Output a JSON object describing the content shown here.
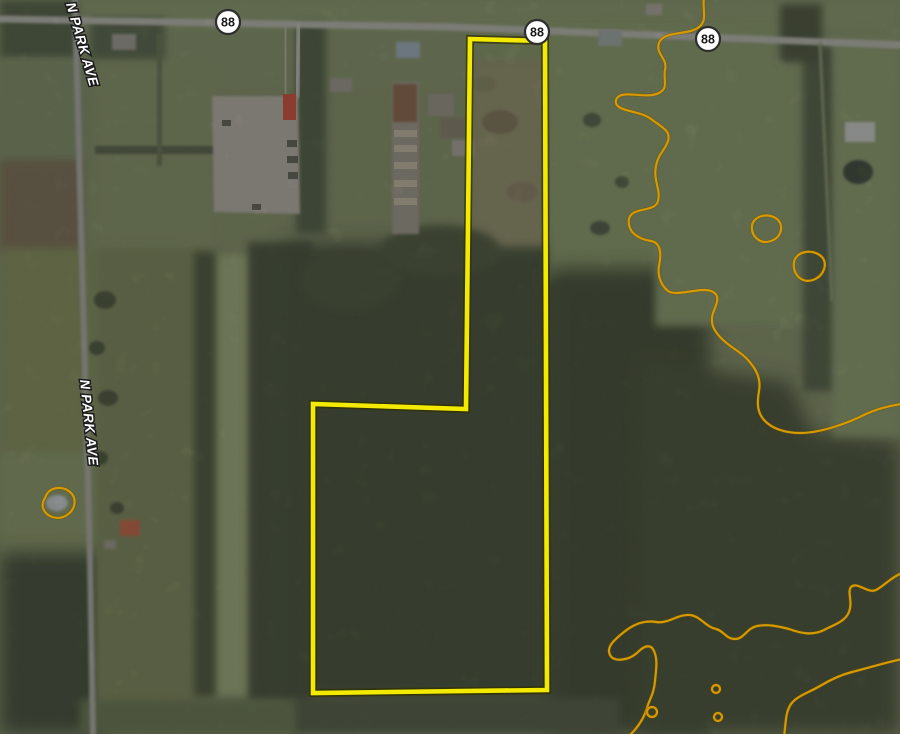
{
  "map": {
    "width": 900,
    "height": 734,
    "background": "#75815a",
    "palette": {
      "boundary_yellow": "#f3ea00",
      "boundary_edge": "#2f2f00",
      "contour_orange": "#d69a00",
      "contour_edge": "#6b4e00",
      "road_gray": "#a8a8a0",
      "shield_fill": "#ffffff",
      "shield_border": "#2d2d2d",
      "label_white": "#ffffff"
    },
    "street_labels": [
      {
        "text": "N PARK AVE",
        "x": 66,
        "y": 4,
        "rot": 74,
        "size": 13.5
      },
      {
        "text": "N PARK AVE",
        "x": 80,
        "y": 380,
        "rot": 84,
        "size": 13.5
      }
    ],
    "route_shields": [
      {
        "label": "88",
        "x": 228,
        "y": 22,
        "r": 12
      },
      {
        "label": "88",
        "x": 537,
        "y": 32,
        "r": 12
      },
      {
        "label": "88",
        "x": 708,
        "y": 39,
        "r": 12
      }
    ],
    "boundary": {
      "name": "property-boundary",
      "points": "470,39 545,41 547,690 313,693 313,404 466,409",
      "width": 4.6,
      "edge_width": 8
    },
    "contours": {
      "width": 2.2,
      "edge_width": 3.6,
      "paths": [
        {
          "name": "contour-line-upper",
          "d": "M 704,-3 C 702,10 708,20 699,27 C 688,36 664,30 659,43 C 655,54 668,58 665,70 C 663,80 669,88 659,93 C 645,100 620,88 616,100 C 613,112 640,110 651,119 C 663,128 671,131 668,141 C 664,152 658,154 656,166 C 653,180 661,190 658,201 C 655,213 632,206 629,219 C 627,231 637,239 651,241 C 662,243 661,256 659,266 C 657,278 663,287 668,291 C 676,297 700,287 711,291 C 722,295 716,305 713,313 C 710,323 713,330 722,339 C 731,348 740,351 748,360 C 757,370 761,379 759,391 C 757,403 757,412 764,420 C 772,429 786,433 800,433 C 820,433 846,424 866,414 C 877,409 888,406 902,404"
        },
        {
          "name": "contour-line-lower",
          "d": "M 902,573 C 890,578 884,586 876,590 C 868,594 857,581 851,587 C 847,592 853,602 849,612 C 845,622 833,625 824,630 C 812,636 800,633 789,629 C 777,626 768,624 757,626 C 747,628 744,639 735,639 C 726,639 724,631 716,629 C 706,627 700,616 690,615 C 678,614 668,624 656,622 C 644,620 634,624 624,632 C 614,640 606,647 610,655 C 614,663 630,660 638,652 C 645,645 651,644 654,651 C 658,660 656,670 655,681 C 654,694 649,700 647,708 C 644,718 639,726 631,734"
        },
        {
          "name": "contour-line-corner",
          "d": "M 902,659 C 884,663 868,668 852,672 C 840,675 830,680 820,686 C 808,693 797,696 791,704 C 785,713 786,724 784,736"
        },
        {
          "name": "contour-ring",
          "d": "M 752,226 C 753,216 768,212 777,219 C 784,225 782,237 771,241 C 760,245 751,236 752,226 Z"
        },
        {
          "name": "contour-ring",
          "d": "M 794,262 C 796,251 813,248 822,257 C 828,264 824,276 813,280 C 801,284 792,273 794,262 Z"
        },
        {
          "name": "contour-ring-pond",
          "d": "M 45,498 C 48,487 62,485 70,492 C 77,498 76,509 67,515 C 58,521 46,517 43,508 C 42,504 43,501 45,498 Z"
        }
      ],
      "rings": [
        {
          "name": "contour-ring-small",
          "cx": 652,
          "cy": 712,
          "r": 5
        },
        {
          "name": "contour-ring-small",
          "cx": 716,
          "cy": 689,
          "r": 4
        },
        {
          "name": "contour-ring-small",
          "cx": 718,
          "cy": 717,
          "r": 4
        }
      ]
    },
    "roads": [
      {
        "name": "route-88-road",
        "pts": "0,19 450,27 900,45",
        "w": 7,
        "stroke": "#a8a8a0"
      },
      {
        "name": "n-park-ave-road",
        "pts": "75,0 83,300 90,560 93,734",
        "w": 6,
        "stroke": "#9c9c95"
      },
      {
        "name": "side-road",
        "pts": "299,26 297,96",
        "w": 5,
        "stroke": "#b2b2aa"
      },
      {
        "name": "driveway",
        "pts": "285,28 286,96",
        "w": 3,
        "stroke": "#aeaaa0"
      },
      {
        "name": "farm-lane",
        "pts": "820,44 832,300",
        "w": 3,
        "stroke": "#7d8a62"
      }
    ],
    "patches": [
      {
        "t": "rect",
        "x": 0,
        "y": 0,
        "w": 900,
        "h": 34,
        "fill": "#7b8a5f",
        "f": 2,
        "name": "field"
      },
      {
        "t": "rect",
        "x": 0,
        "y": 30,
        "w": 900,
        "h": 60,
        "fill": "#78855c",
        "f": 2,
        "name": "field"
      },
      {
        "t": "rect",
        "x": 0,
        "y": 0,
        "w": 78,
        "h": 58,
        "fill": "#46523a",
        "f": 2,
        "name": "trees"
      },
      {
        "t": "rect",
        "x": 90,
        "y": 18,
        "w": 75,
        "h": 45,
        "fill": "#4e5a40",
        "f": 2,
        "name": "trees"
      },
      {
        "t": "rect",
        "x": 0,
        "y": 60,
        "w": 95,
        "h": 110,
        "fill": "#72805a",
        "f": 2,
        "name": "field"
      },
      {
        "t": "rect",
        "x": 0,
        "y": 160,
        "w": 82,
        "h": 95,
        "fill": "#6e6249",
        "f": 2,
        "name": "plowed-field"
      },
      {
        "t": "rect",
        "x": 0,
        "y": 248,
        "w": 95,
        "h": 215,
        "fill": "#76804f",
        "f": 2,
        "name": "field"
      },
      {
        "t": "rect",
        "x": 0,
        "y": 452,
        "w": 100,
        "h": 115,
        "fill": "#7d8a5c",
        "f": 2,
        "name": "lawn"
      },
      {
        "t": "rect",
        "x": 0,
        "y": 552,
        "w": 108,
        "h": 182,
        "fill": "#39432e",
        "f": 3,
        "name": "trees"
      },
      {
        "t": "rect",
        "x": 95,
        "y": 60,
        "w": 120,
        "h": 190,
        "fill": "#77845a",
        "f": 2,
        "name": "field"
      },
      {
        "t": "rect",
        "x": 95,
        "y": 248,
        "w": 115,
        "h": 465,
        "fill": "#6f7a50",
        "f": 2,
        "name": "field"
      },
      {
        "t": "rect",
        "x": 211,
        "y": 255,
        "w": 42,
        "h": 440,
        "fill": "#8e9b6c",
        "f": 2,
        "name": "grass-strip"
      },
      {
        "t": "rect",
        "x": 194,
        "y": 252,
        "w": 22,
        "h": 445,
        "fill": "#414c33",
        "f": 2,
        "name": "tree-row"
      },
      {
        "t": "rect",
        "x": 248,
        "y": 242,
        "w": 64,
        "h": 460,
        "fill": "#3c4731",
        "f": 2,
        "name": "tree-row"
      },
      {
        "t": "rect",
        "x": 283,
        "y": 243,
        "w": 282,
        "h": 460,
        "fill": "#3b452d",
        "f": 3,
        "name": "forest"
      },
      {
        "t": "rect",
        "x": 296,
        "y": 24,
        "w": 30,
        "h": 210,
        "fill": "#45513a",
        "f": 2,
        "name": "tree-row"
      },
      {
        "t": "rect",
        "x": 468,
        "y": 34,
        "w": 80,
        "h": 42,
        "fill": "#77875a",
        "f": 2,
        "name": "field"
      },
      {
        "t": "rect",
        "x": 470,
        "y": 60,
        "w": 76,
        "h": 185,
        "fill": "#84815e",
        "f": 2,
        "name": "scrub-field"
      },
      {
        "t": "rect",
        "x": 548,
        "y": 26,
        "w": 185,
        "h": 255,
        "fill": "#7c8c5d",
        "f": 2,
        "name": "field"
      },
      {
        "t": "rect",
        "x": 548,
        "y": 268,
        "w": 162,
        "h": 466,
        "fill": "#38422c",
        "f": 3,
        "name": "forest"
      },
      {
        "t": "polygon",
        "pts": "640,360 790,382 812,432 900,442 900,734 640,734",
        "fill": "#3c462e",
        "f": 3,
        "name": "forest"
      },
      {
        "t": "rect",
        "x": 655,
        "y": 26,
        "w": 150,
        "h": 300,
        "fill": "#7b8b5e",
        "f": 2,
        "name": "field"
      },
      {
        "t": "rect",
        "x": 803,
        "y": 46,
        "w": 32,
        "h": 345,
        "fill": "#46523a",
        "f": 2,
        "name": "tree-row"
      },
      {
        "t": "rect",
        "x": 833,
        "y": 36,
        "w": 67,
        "h": 400,
        "fill": "#7e8d60",
        "f": 2,
        "name": "field"
      },
      {
        "t": "rect",
        "x": 780,
        "y": 4,
        "w": 42,
        "h": 58,
        "fill": "#3f4a33",
        "f": 2,
        "name": "trees"
      },
      {
        "t": "rect",
        "x": 95,
        "y": 146,
        "w": 120,
        "h": 8,
        "fill": "#4b573d",
        "f": 1,
        "name": "hedgerow"
      },
      {
        "t": "rect",
        "x": 157,
        "y": 34,
        "w": 5,
        "h": 132,
        "fill": "#5a6647",
        "f": 1,
        "name": "hedgerow"
      },
      {
        "t": "rect",
        "x": 290,
        "y": 698,
        "w": 330,
        "h": 36,
        "fill": "#46513a",
        "f": 2,
        "name": "trees"
      },
      {
        "t": "rect",
        "x": 80,
        "y": 700,
        "w": 215,
        "h": 34,
        "fill": "#5c6a45",
        "f": 2,
        "name": "field"
      },
      {
        "t": "ellipse",
        "cx": 105,
        "cy": 300,
        "rx": 11,
        "ry": 9,
        "fill": "#3f4a33",
        "f": 1,
        "name": "tree-clump"
      },
      {
        "t": "ellipse",
        "cx": 97,
        "cy": 348,
        "rx": 8,
        "ry": 7,
        "fill": "#3f4a33",
        "f": 1,
        "name": "tree-clump"
      },
      {
        "t": "ellipse",
        "cx": 108,
        "cy": 398,
        "rx": 10,
        "ry": 8,
        "fill": "#3f4a33",
        "f": 1,
        "name": "tree-clump"
      },
      {
        "t": "ellipse",
        "cx": 100,
        "cy": 458,
        "rx": 8,
        "ry": 7,
        "fill": "#3f4a33",
        "f": 1,
        "name": "tree-clump"
      },
      {
        "t": "ellipse",
        "cx": 117,
        "cy": 508,
        "rx": 7,
        "ry": 6,
        "fill": "#3f4a33",
        "f": 1,
        "name": "tree-clump"
      },
      {
        "t": "ellipse",
        "cx": 500,
        "cy": 122,
        "rx": 18,
        "ry": 12,
        "fill": "#6e6448",
        "f": 1,
        "op": 0.85,
        "name": "scrub-patch"
      },
      {
        "t": "ellipse",
        "cx": 522,
        "cy": 192,
        "rx": 15,
        "ry": 10,
        "fill": "#7b7054",
        "f": 1,
        "op": 0.8,
        "name": "scrub-patch"
      },
      {
        "t": "ellipse",
        "cx": 484,
        "cy": 84,
        "rx": 12,
        "ry": 8,
        "fill": "#7a7851",
        "f": 1,
        "op": 0.8,
        "name": "scrub-patch"
      },
      {
        "t": "ellipse",
        "cx": 592,
        "cy": 120,
        "rx": 9,
        "ry": 7,
        "fill": "#4a553c",
        "f": 1,
        "name": "tree-clump"
      },
      {
        "t": "ellipse",
        "cx": 622,
        "cy": 182,
        "rx": 7,
        "ry": 6,
        "fill": "#4a553c",
        "f": 1,
        "name": "tree-clump"
      },
      {
        "t": "ellipse",
        "cx": 600,
        "cy": 228,
        "rx": 10,
        "ry": 7,
        "fill": "#44503a",
        "f": 1,
        "name": "tree-clump"
      },
      {
        "t": "ellipse",
        "cx": 440,
        "cy": 250,
        "rx": 60,
        "ry": 25,
        "fill": "#424d33",
        "f": 2,
        "name": "trees"
      },
      {
        "t": "ellipse",
        "cx": 350,
        "cy": 280,
        "rx": 50,
        "ry": 30,
        "fill": "#3f4a31",
        "f": 2,
        "name": "trees"
      }
    ],
    "structures": [
      {
        "t": "polygon",
        "pts": "212,96 298,96 300,214 214,212",
        "fill": "#a5a196",
        "f": 1,
        "name": "parking-lot"
      },
      {
        "t": "rect",
        "x": 283,
        "y": 94,
        "w": 13,
        "h": 26,
        "fill": "#c0432f",
        "f": 0,
        "name": "red-truck"
      },
      {
        "t": "rect",
        "x": 287,
        "y": 140,
        "w": 10,
        "h": 7,
        "fill": "#55554e",
        "f": 0,
        "name": "vehicle"
      },
      {
        "t": "rect",
        "x": 287,
        "y": 156,
        "w": 11,
        "h": 7,
        "fill": "#55554e",
        "f": 0,
        "name": "vehicle"
      },
      {
        "t": "rect",
        "x": 288,
        "y": 172,
        "w": 10,
        "h": 7,
        "fill": "#55554e",
        "f": 0,
        "name": "vehicle"
      },
      {
        "t": "rect",
        "x": 252,
        "y": 204,
        "w": 9,
        "h": 6,
        "fill": "#55554e",
        "f": 0,
        "name": "vehicle"
      },
      {
        "t": "rect",
        "x": 222,
        "y": 120,
        "w": 9,
        "h": 6,
        "fill": "#55554e",
        "f": 0,
        "name": "vehicle"
      },
      {
        "t": "rect",
        "x": 392,
        "y": 82,
        "w": 27,
        "h": 152,
        "fill": "#8f8a7c",
        "f": 1,
        "name": "nursery-rows"
      },
      {
        "t": "rect",
        "x": 393,
        "y": 84,
        "w": 24,
        "h": 38,
        "fill": "#7d5a40",
        "f": 1,
        "name": "nursery-rows"
      },
      {
        "t": "rect",
        "x": 394,
        "y": 130,
        "w": 23,
        "h": 7,
        "fill": "#b0a791",
        "f": 0,
        "name": "nursery-row"
      },
      {
        "t": "rect",
        "x": 394,
        "y": 145,
        "w": 23,
        "h": 7,
        "fill": "#b0a791",
        "f": 0,
        "name": "nursery-row"
      },
      {
        "t": "rect",
        "x": 394,
        "y": 162,
        "w": 23,
        "h": 7,
        "fill": "#b0a791",
        "f": 0,
        "name": "nursery-row"
      },
      {
        "t": "rect",
        "x": 394,
        "y": 180,
        "w": 23,
        "h": 7,
        "fill": "#b0a791",
        "f": 0,
        "name": "nursery-row"
      },
      {
        "t": "rect",
        "x": 394,
        "y": 198,
        "w": 23,
        "h": 7,
        "fill": "#b0a791",
        "f": 0,
        "name": "nursery-row"
      },
      {
        "t": "rect",
        "x": 428,
        "y": 94,
        "w": 26,
        "h": 22,
        "fill": "#8a857a",
        "f": 1,
        "name": "farm-building"
      },
      {
        "t": "rect",
        "x": 440,
        "y": 118,
        "w": 26,
        "h": 20,
        "fill": "#77725f",
        "f": 1,
        "name": "farm-building"
      },
      {
        "t": "rect",
        "x": 452,
        "y": 140,
        "w": 22,
        "h": 16,
        "fill": "#9a958a",
        "f": 1,
        "name": "farm-building"
      },
      {
        "t": "rect",
        "x": 112,
        "y": 34,
        "w": 24,
        "h": 16,
        "fill": "#8f8c82",
        "f": 1,
        "name": "house"
      },
      {
        "t": "rect",
        "x": 330,
        "y": 78,
        "w": 22,
        "h": 14,
        "fill": "#8b887e",
        "f": 1,
        "name": "house"
      },
      {
        "t": "rect",
        "x": 396,
        "y": 42,
        "w": 24,
        "h": 16,
        "fill": "#8d9dab",
        "f": 1,
        "name": "house"
      },
      {
        "t": "rect",
        "x": 598,
        "y": 30,
        "w": 24,
        "h": 16,
        "fill": "#8e9894",
        "f": 1,
        "name": "house"
      },
      {
        "t": "rect",
        "x": 646,
        "y": 4,
        "w": 16,
        "h": 11,
        "fill": "#9b978d",
        "f": 1,
        "name": "house"
      },
      {
        "t": "rect",
        "x": 845,
        "y": 122,
        "w": 30,
        "h": 20,
        "fill": "#b7bcb8",
        "f": 1,
        "name": "house"
      },
      {
        "t": "ellipse",
        "cx": 858,
        "cy": 172,
        "rx": 15,
        "ry": 12,
        "fill": "#333c2f",
        "f": 1,
        "name": "pond"
      },
      {
        "t": "ellipse",
        "cx": 57,
        "cy": 503,
        "rx": 11,
        "ry": 8,
        "fill": "#b3b9ba",
        "f": 1,
        "name": "pond"
      },
      {
        "t": "rect",
        "x": 120,
        "y": 520,
        "w": 20,
        "h": 16,
        "fill": "#b05a3a",
        "f": 1,
        "name": "house"
      },
      {
        "t": "rect",
        "x": 104,
        "y": 540,
        "w": 12,
        "h": 9,
        "fill": "#8b887b",
        "f": 1,
        "name": "shed"
      }
    ],
    "grain": [
      {
        "freq": 0.9,
        "oct": 2,
        "seed": 7,
        "white": false,
        "op": 0.18
      },
      {
        "freq": 0.9,
        "oct": 2,
        "seed": 42,
        "white": true,
        "op": 0.08
      },
      {
        "freq": 0.045,
        "oct": 3,
        "seed": 11,
        "white": false,
        "op": 0.14
      }
    ]
  }
}
